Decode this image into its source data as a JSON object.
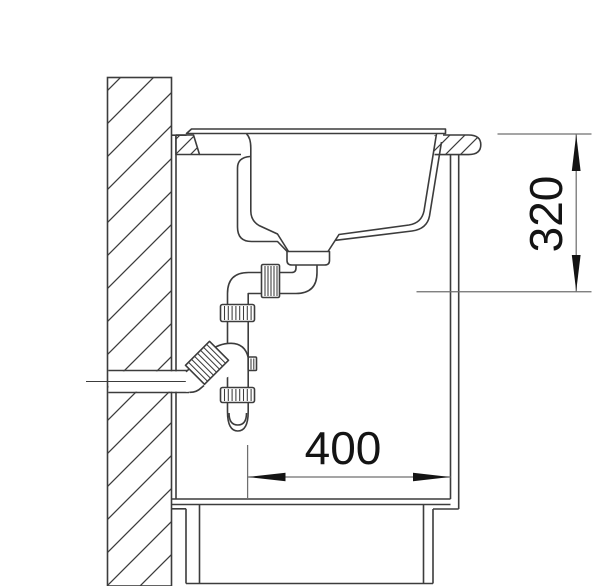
{
  "diagram": {
    "dimensions": {
      "horizontal": {
        "value": "400"
      },
      "vertical": {
        "value": "320"
      }
    },
    "colors": {
      "line": "#3c3c3c",
      "dimension_line": "#6f6f6f",
      "arrow_and_text": "#141414",
      "background": "#ffffff"
    }
  }
}
